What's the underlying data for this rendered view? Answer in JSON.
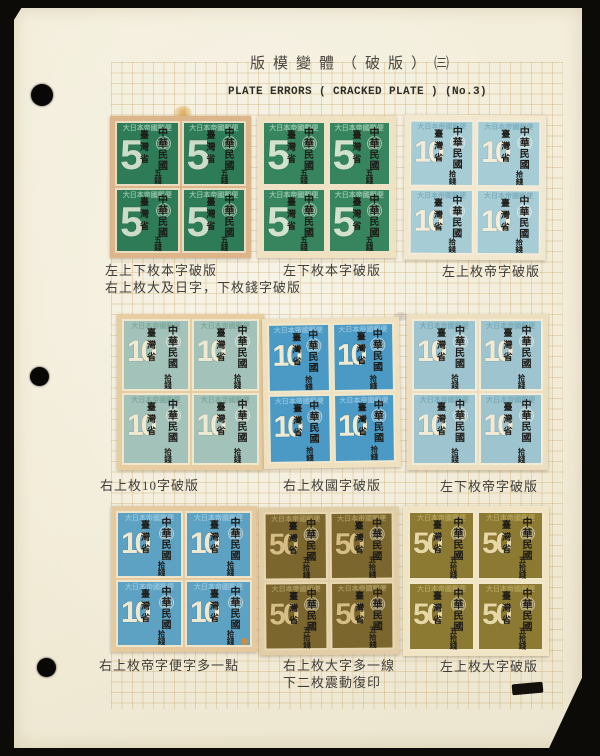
{
  "page": {
    "title_cn": "版模變體（破版）㈢",
    "title_en": "PLATE ERRORS ( CRACKED PLATE ) (No.3)"
  },
  "blocks": [
    {
      "id": "block-1",
      "numeral": "5",
      "denomination": "五錢",
      "top_band": "大日本帝國郵便",
      "overprint_left": "臺灣省",
      "overprint_right": "中華民國",
      "stamp_color": "#2d7b57",
      "numeral_color": "#ccdcc8",
      "band_color": "#8fbfa4",
      "backing_color": "#dcb58b",
      "paper_color": "#e9dcc2",
      "caption": [
        "左上下枚本字破版",
        "右上枚大及日字，下枚錢字破版"
      ]
    },
    {
      "id": "block-2",
      "numeral": "5",
      "denomination": "五錢",
      "top_band": "大日本帝國郵便",
      "overprint_left": "臺灣省",
      "overprint_right": "中華民國",
      "stamp_color": "#36855f",
      "numeral_color": "#d2e2cc",
      "band_color": "#93c2a8",
      "backing_color": "#f0e1c1",
      "paper_color": "#eee3c6",
      "caption": [
        "左下枚本字破版"
      ]
    },
    {
      "id": "block-3",
      "numeral": "10",
      "denomination": "拾錢",
      "top_band": "大日本帝國郵便",
      "overprint_left": "臺灣省",
      "overprint_right": "中華民國",
      "stamp_color": "#a6ccd5",
      "numeral_color": "#f2ecd8",
      "band_color": "#7fb0bf",
      "backing_color": "#f2e7cf",
      "paper_color": "#f3ecd8",
      "caption": [
        "左上枚帝字破版"
      ]
    },
    {
      "id": "block-4",
      "numeral": "10",
      "denomination": "拾錢",
      "top_band": "大日本帝國郵便",
      "overprint_left": "臺灣省",
      "overprint_right": "中華民國",
      "stamp_color": "#a3c2b9",
      "numeral_color": "#efe9d2",
      "band_color": "#7da89e",
      "backing_color": "#e8cda1",
      "paper_color": "#efe6cc",
      "caption": [
        "右上枚10字破版"
      ]
    },
    {
      "id": "block-5",
      "numeral": "10",
      "denomination": "拾錢",
      "top_band": "大日本帝國郵便",
      "overprint_left": "臺灣省",
      "overprint_right": "中華民國",
      "stamp_color": "#4a9ac5",
      "numeral_color": "#efead2",
      "band_color": "#8cc0dd",
      "backing_color": "#efe0bf",
      "paper_color": "#f0e8cd",
      "caption": [
        "右上枚國字破版"
      ]
    },
    {
      "id": "block-6",
      "numeral": "10",
      "denomination": "拾錢",
      "top_band": "大日本帝國郵便",
      "overprint_left": "臺灣省",
      "overprint_right": "中華民國",
      "stamp_color": "#9ec5cf",
      "numeral_color": "#f1ebd6",
      "band_color": "#78aab8",
      "backing_color": "#eedec0",
      "paper_color": "#f2ebd6",
      "caption": [
        "左下枚帝字破版"
      ]
    },
    {
      "id": "block-7",
      "numeral": "10",
      "denomination": "拾錢",
      "top_band": "大日本帝國郵便",
      "overprint_left": "臺灣省",
      "overprint_right": "中華民國",
      "stamp_color": "#5da1c3",
      "numeral_color": "#efe8d0",
      "band_color": "#92c3da",
      "backing_color": "#e5ca9f",
      "paper_color": "#eee4c9",
      "caption": [
        "右上枚帝字便字多一點"
      ]
    },
    {
      "id": "block-8",
      "numeral": "50",
      "denomination": "五拾錢",
      "top_band": "大日本帝國郵便",
      "overprint_left": "臺灣省",
      "overprint_right": "中華民國",
      "stamp_color": "#7b672d",
      "numeral_color": "#d5bd83",
      "band_color": "#a9965a",
      "backing_color": "#e1cea7",
      "paper_color": "#e8d8b2",
      "caption": [
        "右上枚大字多一線",
        "下二枚震動復印"
      ]
    },
    {
      "id": "block-9",
      "numeral": "50",
      "denomination": "五拾錢",
      "top_band": "大日本帝國郵便",
      "overprint_left": "臺灣省",
      "overprint_right": "中華民國",
      "stamp_color": "#8c7932",
      "numeral_color": "#e6d7a6",
      "band_color": "#b3a159",
      "backing_color": "#f0e4c5",
      "paper_color": "#f1e7ca",
      "caption": [
        "左上枚大字破版"
      ]
    }
  ]
}
